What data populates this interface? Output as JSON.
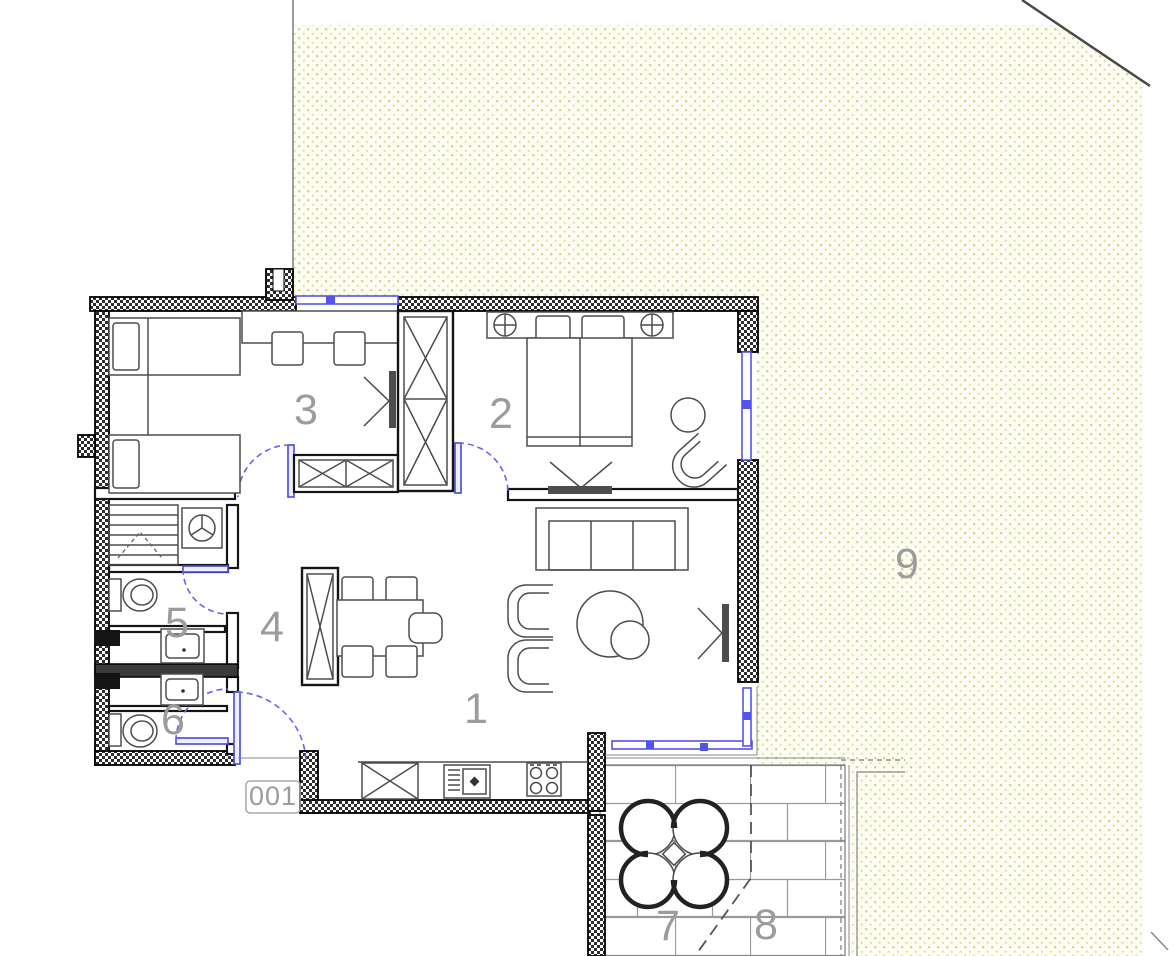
{
  "plan": {
    "unit_label": "001",
    "rooms": [
      {
        "number": "1"
      },
      {
        "number": "2"
      },
      {
        "number": "3"
      },
      {
        "number": "4"
      },
      {
        "number": "5"
      },
      {
        "number": "6"
      },
      {
        "number": "7"
      },
      {
        "number": "8"
      },
      {
        "number": "9"
      }
    ],
    "colors": {
      "opening_blue": "#5353ef",
      "dot_yellow": "#ccd083",
      "wall_black": "#141414",
      "furniture_gray": "#4d4d4d",
      "label_gray": "#9c9c9c",
      "brick_gray": "#9a9a9a"
    }
  }
}
